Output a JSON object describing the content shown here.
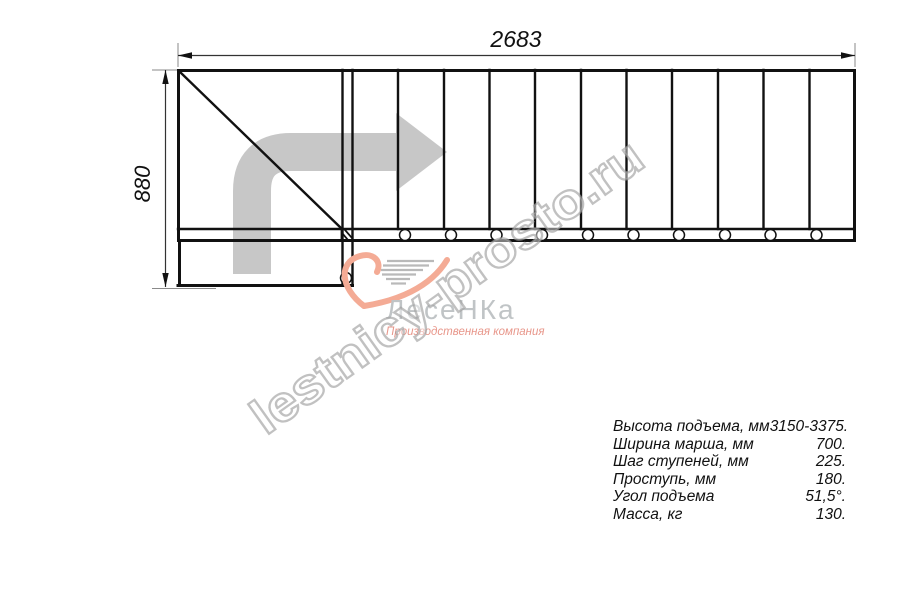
{
  "drawing": {
    "title": "staircase-plan",
    "width_label": "2683",
    "height_label": "880",
    "tread_count": 11,
    "line_color": "#111111",
    "arrow_color": "#c7c7c7"
  },
  "watermark": {
    "text": "lestnicy-prosto.ru"
  },
  "logo": {
    "name": "ЛесеНКа",
    "tagline": "Производственная компания",
    "accent_color": "#f4ab95",
    "text_color": "#c0c4c6"
  },
  "specs": {
    "rows": [
      {
        "label": "Высота подъема, мм",
        "value": "3150-3375."
      },
      {
        "label": "Ширина марша, мм",
        "value": "700."
      },
      {
        "label": "Шаг ступеней, мм",
        "value": "225."
      },
      {
        "label": "Проступь, мм",
        "value": "180."
      },
      {
        "label": "Угол подъема",
        "value": "51,5°."
      },
      {
        "label": "Масса, кг",
        "value": "130."
      }
    ]
  }
}
